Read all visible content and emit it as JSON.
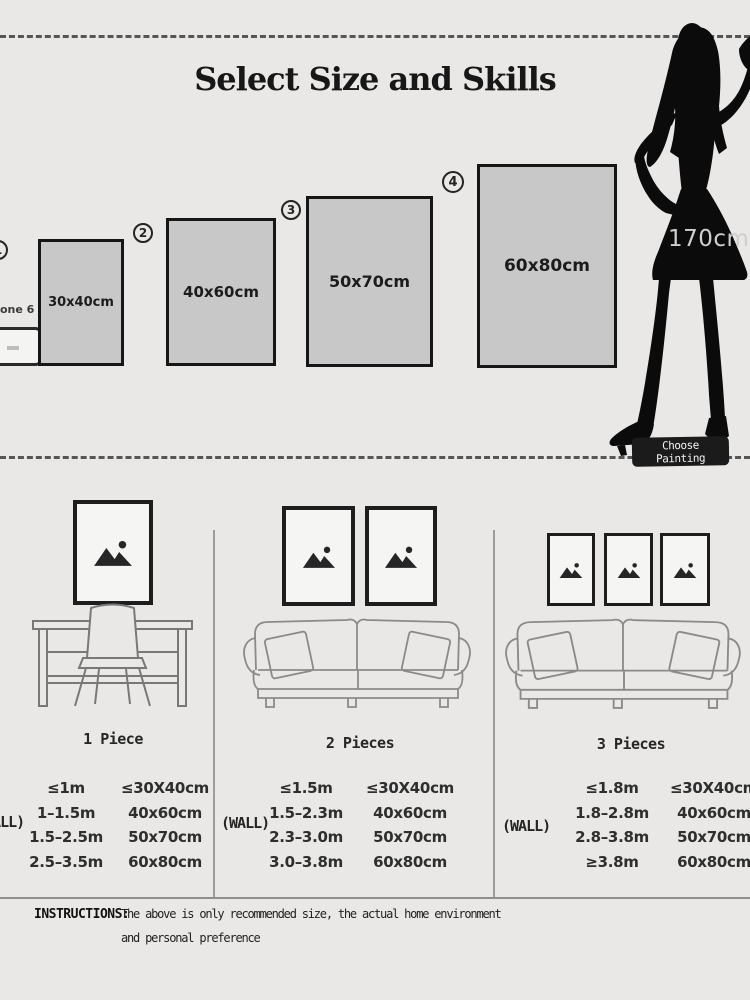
{
  "title": "Select Size and Skills",
  "reference": {
    "phone_label": "one 6",
    "height_label": "170cm",
    "button_label": "Choose Painting"
  },
  "sizes": [
    {
      "number": "1",
      "label": "30x40cm"
    },
    {
      "number": "2",
      "label": "40x60cm"
    },
    {
      "number": "3",
      "label": "50x70cm"
    },
    {
      "number": "4",
      "label": "60x80cm"
    }
  ],
  "scenes": [
    {
      "label": "1 Piece"
    },
    {
      "label": "2 Pieces"
    },
    {
      "label": "3 Pieces"
    }
  ],
  "tables": [
    {
      "wall_label": "(WALL)",
      "rows": [
        [
          "≤1m",
          "≤30X40cm"
        ],
        [
          "1–1.5m",
          "40x60cm"
        ],
        [
          "1.5–2.5m",
          "50x70cm"
        ],
        [
          "2.5–3.5m",
          "60x80cm"
        ]
      ]
    },
    {
      "wall_label": "(WALL)",
      "rows": [
        [
          "≤1.5m",
          "≤30X40cm"
        ],
        [
          "1.5–2.3m",
          "40x60cm"
        ],
        [
          "2.3–3.0m",
          "50x70cm"
        ],
        [
          "3.0–3.8m",
          "60x80cm"
        ]
      ]
    },
    {
      "wall_label": "(WALL)",
      "rows": [
        [
          "≤1.8m",
          "≤30X40cm"
        ],
        [
          "1.8–2.8m",
          "40x60cm"
        ],
        [
          "2.8–3.8m",
          "50x70cm"
        ],
        [
          "≥3.8m",
          "60x80cm"
        ]
      ]
    }
  ],
  "instructions": {
    "label": "INSTRUCTIONS:",
    "line1": "The above is only recommended size, the actual home environment",
    "line2": "and personal preference"
  },
  "icons": {
    "frame_icon": "image-placeholder-icon",
    "figure": "woman-silhouette",
    "scene1_furniture": "desk-and-chair",
    "scene2_furniture": "sofa",
    "scene3_furniture": "sofa",
    "phone": "smartphone-outline"
  },
  "colors": {
    "background": "#e9e8e6",
    "swatch_fill": "#c8c8c8",
    "frame_border": "#1d1d1d",
    "silhouette": "#0b0b0b",
    "button_bg": "#1b1b1b",
    "divider": "#9c9c9c"
  }
}
